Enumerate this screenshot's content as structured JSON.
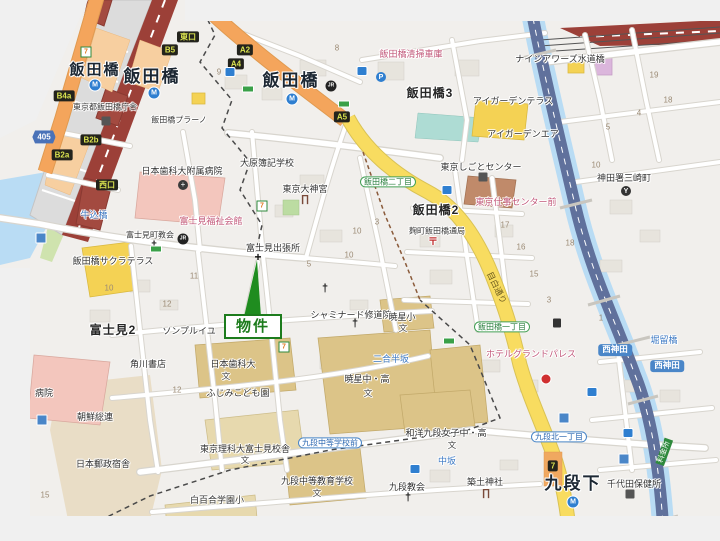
{
  "map": {
    "property_marker": {
      "label": "物件",
      "color": "#1d7c1d"
    },
    "colors": {
      "canvas_edge": "#f0f0f0",
      "block_base": "#f1efec",
      "water": "#b9dcf4",
      "expressway": "#60719c",
      "jr_line": "#9c4038",
      "road_orange": "#f4a55c",
      "road_yellow": "#f8dc60",
      "park_green": "#cfe3ae",
      "field_teal": "#aedcd4",
      "school_tan": "#dcc488",
      "hospital_pink": "#f3c6bd",
      "marker_green": "#1d7c1d"
    },
    "labels": [
      {
        "text": "東口",
        "x": 188,
        "y": 37,
        "cls": "exit",
        "name": "exit-badge-higashiguchi"
      },
      {
        "text": "B5",
        "x": 170,
        "y": 50,
        "cls": "exit",
        "name": "exit-badge-b5"
      },
      {
        "text": "A2",
        "x": 245,
        "y": 50,
        "cls": "exit",
        "name": "exit-badge-a2"
      },
      {
        "text": "A4",
        "x": 236,
        "y": 64,
        "cls": "exit",
        "name": "exit-badge-a4"
      },
      {
        "text": "A5",
        "x": 342,
        "y": 117,
        "cls": "exit",
        "name": "exit-badge-a5"
      },
      {
        "text": "B4a",
        "x": 64,
        "y": 96,
        "cls": "exit",
        "name": "exit-badge-b4a"
      },
      {
        "text": "B2b",
        "x": 91,
        "y": 140,
        "cls": "exit",
        "name": "exit-badge-b2b"
      },
      {
        "text": "B2a",
        "x": 62,
        "y": 155,
        "cls": "exit",
        "name": "exit-badge-b2a"
      },
      {
        "text": "西口",
        "x": 107,
        "y": 185,
        "cls": "exit",
        "name": "exit-badge-nishiguchi"
      },
      {
        "text": "7",
        "x": 553,
        "y": 466,
        "cls": "exit",
        "name": "exit-badge-7"
      },
      {
        "text": "405",
        "x": 44,
        "y": 137,
        "cls": "route",
        "name": "route-badge-405"
      },
      {
        "text": "飯田橋",
        "x": 95,
        "y": 70,
        "cls": "station",
        "name": "station-label-iidabashi-west"
      },
      {
        "text": "飯田橋",
        "x": 152,
        "y": 77,
        "cls": "station-lg",
        "name": "station-label-iidabashi-jr"
      },
      {
        "text": "飯田橋",
        "x": 291,
        "y": 81,
        "cls": "station-lg",
        "name": "station-label-iidabashi-east"
      },
      {
        "text": "九段下",
        "x": 573,
        "y": 484,
        "cls": "station-lg",
        "name": "station-label-kudanshita"
      },
      {
        "text": "飯田橋3",
        "x": 430,
        "y": 94,
        "cls": "district",
        "name": "district-iidabashi-3"
      },
      {
        "text": "飯田橋2",
        "x": 436,
        "y": 211,
        "cls": "district",
        "name": "district-iidabashi-2"
      },
      {
        "text": "富士見2",
        "x": 113,
        "y": 331,
        "cls": "district",
        "name": "district-fujimi-2"
      },
      {
        "text": "東京都飯田橋庁舎",
        "x": 105,
        "y": 107,
        "cls": "place-sm",
        "name": "poi-iidabashi-chosha"
      },
      {
        "text": "飯田橋プラーノ",
        "x": 179,
        "y": 120,
        "cls": "place-sm",
        "name": "poi-iidabashi-plano"
      },
      {
        "text": "日本歯科大附属病院",
        "x": 182,
        "y": 171,
        "cls": "place",
        "name": "poi-dental-univ-hospital"
      },
      {
        "text": "飯田橋清掃車庫",
        "x": 411,
        "y": 54,
        "cls": "pink",
        "name": "poi-seiso-shako"
      },
      {
        "text": "ナインアワーズ水道橋",
        "x": 560,
        "y": 59,
        "cls": "place",
        "name": "poi-nine-hours-suidobashi"
      },
      {
        "text": "アイガーデンテラス",
        "x": 513,
        "y": 101,
        "cls": "place",
        "name": "poi-i-garden-terrace"
      },
      {
        "text": "アイガーデンエア",
        "x": 523,
        "y": 134,
        "cls": "place",
        "name": "poi-i-garden-air"
      },
      {
        "text": "東京しごとセンター",
        "x": 481,
        "y": 167,
        "cls": "place",
        "name": "poi-tokyo-shigoto-center"
      },
      {
        "text": "神田署三崎町",
        "x": 624,
        "y": 178,
        "cls": "place",
        "name": "poi-kanda-police-misakicho"
      },
      {
        "text": "大原簿記学校",
        "x": 267,
        "y": 163,
        "cls": "place",
        "name": "poi-ohara-boki"
      },
      {
        "text": "東京大神宮",
        "x": 305,
        "y": 189,
        "cls": "place",
        "name": "poi-tokyo-daijingu"
      },
      {
        "text": "富士見町教会",
        "x": 150,
        "y": 235,
        "cls": "place-sm",
        "name": "poi-fujimicho-church"
      },
      {
        "text": "富士見福祉会館",
        "x": 211,
        "y": 221,
        "cls": "pink",
        "name": "poi-fujimi-fukushi-kaikan"
      },
      {
        "text": "飯田橋サクラテラス",
        "x": 113,
        "y": 261,
        "cls": "place",
        "name": "poi-sakura-terrace"
      },
      {
        "text": "牛込橋",
        "x": 94,
        "y": 215,
        "cls": "blue",
        "name": "bridge-ushigomebashi"
      },
      {
        "text": "富士見出張所",
        "x": 273,
        "y": 248,
        "cls": "place",
        "name": "poi-fujimi-branch-office"
      },
      {
        "text": "飯田橋二丁目",
        "x": 388,
        "y": 182,
        "cls": "chome",
        "name": "busstop-iidabashi-2chome"
      },
      {
        "text": "麹町飯田橋通局",
        "x": 437,
        "y": 231,
        "cls": "place-sm",
        "name": "poi-kojimachi-iidabashi-post"
      },
      {
        "text": "東京仕事センター前",
        "x": 516,
        "y": 202,
        "cls": "pink",
        "name": "busstop-shigoto-center-mae"
      },
      {
        "text": "ソンプルイユ",
        "x": 189,
        "y": 331,
        "cls": "place",
        "name": "poi-sombreuil"
      },
      {
        "text": "シャミナード修道院",
        "x": 351,
        "y": 315,
        "cls": "place",
        "name": "poi-chaminade-monastery"
      },
      {
        "text": "暁星小",
        "x": 402,
        "y": 317,
        "cls": "place",
        "name": "poi-gyosei-elementary"
      },
      {
        "text": "文",
        "x": 403,
        "y": 329,
        "cls": "bun",
        "name": "school-mark"
      },
      {
        "text": "二合半坂",
        "x": 391,
        "y": 359,
        "cls": "blue",
        "name": "slope-nigohanzaka"
      },
      {
        "text": "ホテルグランドパレス",
        "x": 531,
        "y": 354,
        "cls": "pink",
        "name": "poi-hotel-grand-palace"
      },
      {
        "text": "飯田橋一丁目",
        "x": 502,
        "y": 327,
        "cls": "chome",
        "name": "busstop-iidabashi-1chome"
      },
      {
        "text": "目白通り",
        "x": 496,
        "y": 288,
        "cls": "roadlbl",
        "rot": 64,
        "name": "road-label-mejiro-dori"
      },
      {
        "text": "西神田",
        "x": 615,
        "y": 350,
        "cls": "areab",
        "name": "area-badge-nishikanda-1"
      },
      {
        "text": "西神田",
        "x": 667,
        "y": 366,
        "cls": "areab",
        "name": "area-badge-nishikanda-2"
      },
      {
        "text": "堀留橋",
        "x": 664,
        "y": 340,
        "cls": "blue",
        "name": "bridge-horidomebashi"
      },
      {
        "text": "日本歯科大",
        "x": 233,
        "y": 364,
        "cls": "place",
        "name": "poi-nippon-dental-univ"
      },
      {
        "text": "文",
        "x": 226,
        "y": 377,
        "cls": "bun",
        "name": "school-mark"
      },
      {
        "text": "ふじみこども園",
        "x": 238,
        "y": 393,
        "cls": "place",
        "name": "poi-fujimi-kodomoen"
      },
      {
        "text": "角川書店",
        "x": 148,
        "y": 364,
        "cls": "place",
        "name": "poi-kadokawa-shoten"
      },
      {
        "text": "朝鮮総連",
        "x": 95,
        "y": 417,
        "cls": "place",
        "name": "poi-chosen-soren"
      },
      {
        "text": "日本郵政宿舎",
        "x": 103,
        "y": 464,
        "cls": "place",
        "name": "poi-japan-post-dormitory"
      },
      {
        "text": "病院",
        "x": 44,
        "y": 393,
        "cls": "place",
        "name": "poi-hospital-partial"
      },
      {
        "text": "東京理科大富士見校舎",
        "x": 245,
        "y": 449,
        "cls": "place",
        "name": "poi-tus-fujimi-campus"
      },
      {
        "text": "文",
        "x": 245,
        "y": 461,
        "cls": "bun",
        "name": "school-mark"
      },
      {
        "text": "暁星中・高",
        "x": 367,
        "y": 379,
        "cls": "place",
        "name": "poi-gyosei-jh-hs"
      },
      {
        "text": "文",
        "x": 368,
        "y": 394,
        "cls": "bun",
        "name": "school-mark"
      },
      {
        "text": "白百合学園小",
        "x": 217,
        "y": 500,
        "cls": "place",
        "name": "poi-shirayuri-elementary"
      },
      {
        "text": "九段中等教育学校",
        "x": 317,
        "y": 481,
        "cls": "place",
        "name": "poi-kudan-secondary-school"
      },
      {
        "text": "文",
        "x": 317,
        "y": 494,
        "cls": "bun",
        "name": "school-mark"
      },
      {
        "text": "九段中等学校前",
        "x": 330,
        "y": 443,
        "cls": "busstop",
        "name": "busstop-kudan-chuto-mae"
      },
      {
        "text": "和洋九段女子中・高",
        "x": 446,
        "y": 433,
        "cls": "place",
        "name": "poi-wayo-kudan-girls"
      },
      {
        "text": "文",
        "x": 452,
        "y": 446,
        "cls": "bun",
        "name": "school-mark"
      },
      {
        "text": "中坂",
        "x": 447,
        "y": 461,
        "cls": "blue",
        "name": "slope-nakazaka"
      },
      {
        "text": "九段北一丁目",
        "x": 559,
        "y": 437,
        "cls": "busstop",
        "name": "busstop-kudankita-1chome"
      },
      {
        "text": "千代田保健所",
        "x": 634,
        "y": 484,
        "cls": "place",
        "name": "poi-chiyoda-hokenjo"
      },
      {
        "text": "築土神社",
        "x": 485,
        "y": 482,
        "cls": "place",
        "name": "poi-tsukudo-shrine"
      },
      {
        "text": "九段教会",
        "x": 407,
        "y": 487,
        "cls": "place",
        "name": "poi-kudan-church"
      },
      {
        "text": "料金所",
        "x": 664,
        "y": 452,
        "cls": "toll",
        "rot": -70,
        "name": "toll-gate-badge"
      },
      {
        "text": "8",
        "x": 337,
        "y": 48,
        "cls": "num",
        "name": "block-number"
      },
      {
        "text": "9",
        "x": 219,
        "y": 72,
        "cls": "num",
        "name": "block-number"
      },
      {
        "text": "3",
        "x": 377,
        "y": 222,
        "cls": "num",
        "name": "block-number"
      },
      {
        "text": "10",
        "x": 357,
        "y": 231,
        "cls": "num",
        "name": "block-number"
      },
      {
        "text": "5",
        "x": 309,
        "y": 264,
        "cls": "num",
        "name": "block-number"
      },
      {
        "text": "10",
        "x": 109,
        "y": 288,
        "cls": "num",
        "name": "block-number"
      },
      {
        "text": "11",
        "x": 194,
        "y": 276,
        "cls": "num",
        "name": "block-number"
      },
      {
        "text": "12",
        "x": 167,
        "y": 304,
        "cls": "num",
        "name": "block-number"
      },
      {
        "text": "12",
        "x": 177,
        "y": 390,
        "cls": "num",
        "name": "block-number"
      },
      {
        "text": "15",
        "x": 45,
        "y": 495,
        "cls": "num",
        "name": "block-number"
      },
      {
        "text": "17",
        "x": 505,
        "y": 225,
        "cls": "num",
        "name": "block-number"
      },
      {
        "text": "16",
        "x": 521,
        "y": 247,
        "cls": "num",
        "name": "block-number"
      },
      {
        "text": "15",
        "x": 534,
        "y": 274,
        "cls": "num",
        "name": "block-number"
      },
      {
        "text": "18",
        "x": 570,
        "y": 243,
        "cls": "num",
        "name": "block-number"
      },
      {
        "text": "3",
        "x": 549,
        "y": 300,
        "cls": "num",
        "name": "block-number"
      },
      {
        "text": "1",
        "x": 601,
        "y": 318,
        "cls": "num",
        "name": "block-number"
      },
      {
        "text": "10",
        "x": 596,
        "y": 165,
        "cls": "num",
        "name": "block-number"
      },
      {
        "text": "19",
        "x": 654,
        "y": 75,
        "cls": "num",
        "name": "block-number"
      },
      {
        "text": "18",
        "x": 668,
        "y": 100,
        "cls": "num",
        "name": "block-number"
      },
      {
        "text": "4",
        "x": 639,
        "y": 113,
        "cls": "num",
        "name": "block-number"
      },
      {
        "text": "5",
        "x": 608,
        "y": 127,
        "cls": "num",
        "name": "block-number"
      },
      {
        "text": "10",
        "x": 349,
        "y": 255,
        "cls": "num",
        "name": "block-number"
      }
    ],
    "icons": [
      {
        "type": "metro",
        "glyph": "M",
        "x": 95,
        "y": 85
      },
      {
        "type": "metro",
        "glyph": "M",
        "x": 154,
        "y": 93
      },
      {
        "type": "metro",
        "glyph": "M",
        "x": 292,
        "y": 99
      },
      {
        "type": "metro",
        "glyph": "M",
        "x": 573,
        "y": 502
      },
      {
        "type": "jr",
        "glyph": "JR",
        "x": 331,
        "y": 86
      },
      {
        "type": "jr",
        "glyph": "JR",
        "x": 183,
        "y": 239
      },
      {
        "type": "seven",
        "glyph": "7",
        "x": 86,
        "y": 52
      },
      {
        "type": "seven",
        "glyph": "7",
        "x": 262,
        "y": 206
      },
      {
        "type": "seven",
        "glyph": "7",
        "x": 284,
        "y": 347
      },
      {
        "type": "post",
        "glyph": "〒",
        "x": 433,
        "y": 243
      },
      {
        "type": "torii",
        "glyph": "∏",
        "x": 305,
        "y": 200
      },
      {
        "type": "torii",
        "glyph": "∏",
        "x": 486,
        "y": 494
      },
      {
        "type": "church",
        "glyph": "†",
        "x": 154,
        "y": 246
      },
      {
        "type": "church",
        "glyph": "†",
        "x": 325,
        "y": 289
      },
      {
        "type": "church",
        "glyph": "†",
        "x": 355,
        "y": 324
      },
      {
        "type": "church",
        "glyph": "†",
        "x": 408,
        "y": 498
      },
      {
        "type": "cross",
        "glyph": "+",
        "x": 258,
        "y": 257
      },
      {
        "type": "hospital",
        "glyph": "+",
        "x": 183,
        "y": 185
      },
      {
        "type": "police",
        "glyph": "Y",
        "x": 626,
        "y": 191
      },
      {
        "type": "parking",
        "glyph": "P",
        "x": 381,
        "y": 77
      },
      {
        "type": "bus",
        "glyph": "",
        "x": 230,
        "y": 72
      },
      {
        "type": "bus",
        "glyph": "",
        "x": 362,
        "y": 71
      },
      {
        "type": "bus",
        "glyph": "",
        "x": 447,
        "y": 190
      },
      {
        "type": "bus",
        "glyph": "",
        "x": 592,
        "y": 392
      },
      {
        "type": "bus",
        "glyph": "",
        "x": 628,
        "y": 433
      },
      {
        "type": "bus",
        "glyph": "",
        "x": 415,
        "y": 469
      },
      {
        "type": "busg",
        "glyph": "",
        "x": 248,
        "y": 89
      },
      {
        "type": "busg",
        "glyph": "",
        "x": 344,
        "y": 104
      },
      {
        "type": "busg",
        "glyph": "",
        "x": 156,
        "y": 249
      },
      {
        "type": "busg",
        "glyph": "",
        "x": 449,
        "y": 341
      },
      {
        "type": "gas",
        "glyph": "",
        "x": 557,
        "y": 323
      },
      {
        "type": "red",
        "glyph": "",
        "x": 546,
        "y": 379
      },
      {
        "type": "bluesq",
        "glyph": "",
        "x": 41,
        "y": 238
      },
      {
        "type": "bluesq",
        "glyph": "",
        "x": 42,
        "y": 420
      },
      {
        "type": "bluesq",
        "glyph": "",
        "x": 564,
        "y": 418
      },
      {
        "type": "bluesq",
        "glyph": "",
        "x": 624,
        "y": 459
      },
      {
        "type": "bldg",
        "glyph": "",
        "x": 106,
        "y": 121
      },
      {
        "type": "bldg",
        "glyph": "",
        "x": 483,
        "y": 177
      },
      {
        "type": "bldg",
        "glyph": "",
        "x": 630,
        "y": 494
      }
    ]
  }
}
